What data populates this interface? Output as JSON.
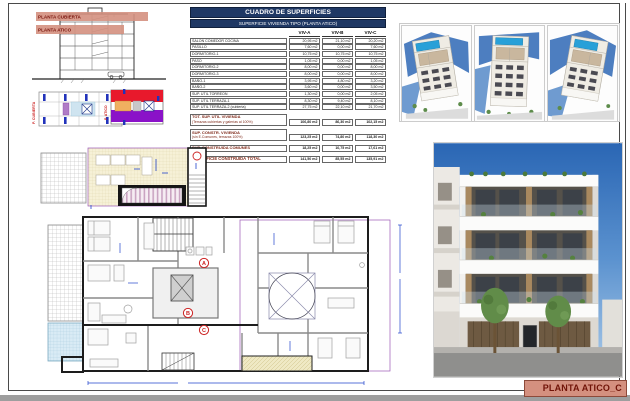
{
  "title_block": {
    "label": "PLANTA ATICO_C"
  },
  "section": {
    "labels": [
      "PLANTA CUBIERTA",
      "PLANTA ATICO"
    ]
  },
  "keyplans": {
    "cubierta_label": "P. CUBIERTA",
    "atico_label": "P. ATICO"
  },
  "plans": {
    "unit_badges": [
      "A",
      "B",
      "C"
    ]
  },
  "table": {
    "title": "CUADRO DE SUPERFICIES",
    "subtitle": "SUPERFICIE VIVIENDA TIPO  (PLANTA ATICO)",
    "columns": [
      "VIV-A",
      "VIV-B",
      "VIV-C"
    ],
    "rows": [
      {
        "label": "SALON COMEDOR COCINA",
        "values": [
          "20,95 m2",
          "21,10 m2",
          "20,20 m2"
        ]
      },
      {
        "label": "PASILLO",
        "values": [
          "7,60 m2",
          "0,00 m2",
          "7,60 m2"
        ]
      },
      {
        "label": "DORMITORIO-1",
        "values": [
          "10,75 m2",
          "10,75 m2",
          "10,75 m2"
        ]
      },
      {
        "label": "PASO",
        "values": [
          "1,05 m2",
          "0,00 m2",
          "1,05 m2"
        ]
      },
      {
        "label": "DORMITORIO-2",
        "values": [
          "8,00 m2",
          "0,00 m2",
          "8,00 m2"
        ]
      },
      {
        "label": "DORMITORIO-3",
        "values": [
          "8,00 m2",
          "0,00 m2",
          "8,00 m2"
        ]
      },
      {
        "label": "BAÑO-1",
        "values": [
          "3,95 m2",
          "4,80 m2",
          "3,20 m2"
        ]
      },
      {
        "label": "BAÑO-2",
        "values": [
          "3,60 m2",
          "0,00 m2",
          "3,50 m2"
        ]
      },
      {
        "label": "SUP. UTIL TORREON",
        "values": [
          "1,30 m2",
          "0,00 m2",
          "2,05 m2"
        ]
      },
      {
        "label": "SUP. UTIL TERRAZA-1",
        "values": [
          "8,30 m2",
          "9,40 m2",
          "8,10 m2"
        ]
      },
      {
        "label": "SUP. UTIL TERRAZA-2 (cubierta)",
        "values": [
          "27,75 m2",
          "22,10 m2",
          "21,70 m2"
        ]
      }
    ],
    "summary_rows": [
      {
        "label": "TOT. SUP. UTIL VIVIENDA",
        "sublabel": "(Terrazas cubiertas y galerías al 100%)",
        "values": [
          "106,80 m2",
          "86,30 m2",
          "102,15 m2"
        ]
      },
      {
        "label": "SUP. CONSTR. VIVIENDA",
        "sublabel": "(sin E.Comunes, terrazas 100%)",
        "values": [
          "123,25 m2",
          "74,80 m2",
          "118,30 m2"
        ]
      },
      {
        "label": "SUP. CONSTRUIDA COMUNES",
        "sublabel": "",
        "values": [
          "18,25 m2",
          "10,75 m2",
          "17,61 m2"
        ]
      },
      {
        "label": "SUPERFICIE CONSTRUIDA TOTAL",
        "sublabel": "",
        "values": [
          "141,50 m2",
          "85,55 m2",
          "135,91 m2"
        ]
      }
    ]
  },
  "colors": {
    "accent_salmon": "#D4907F",
    "table_navy": "#1F3864",
    "label_maroon": "#7F2A1A",
    "badge_red": "#CC2222",
    "dimension_blue": "#2244CC",
    "pool_blue": "#28A0D8"
  }
}
